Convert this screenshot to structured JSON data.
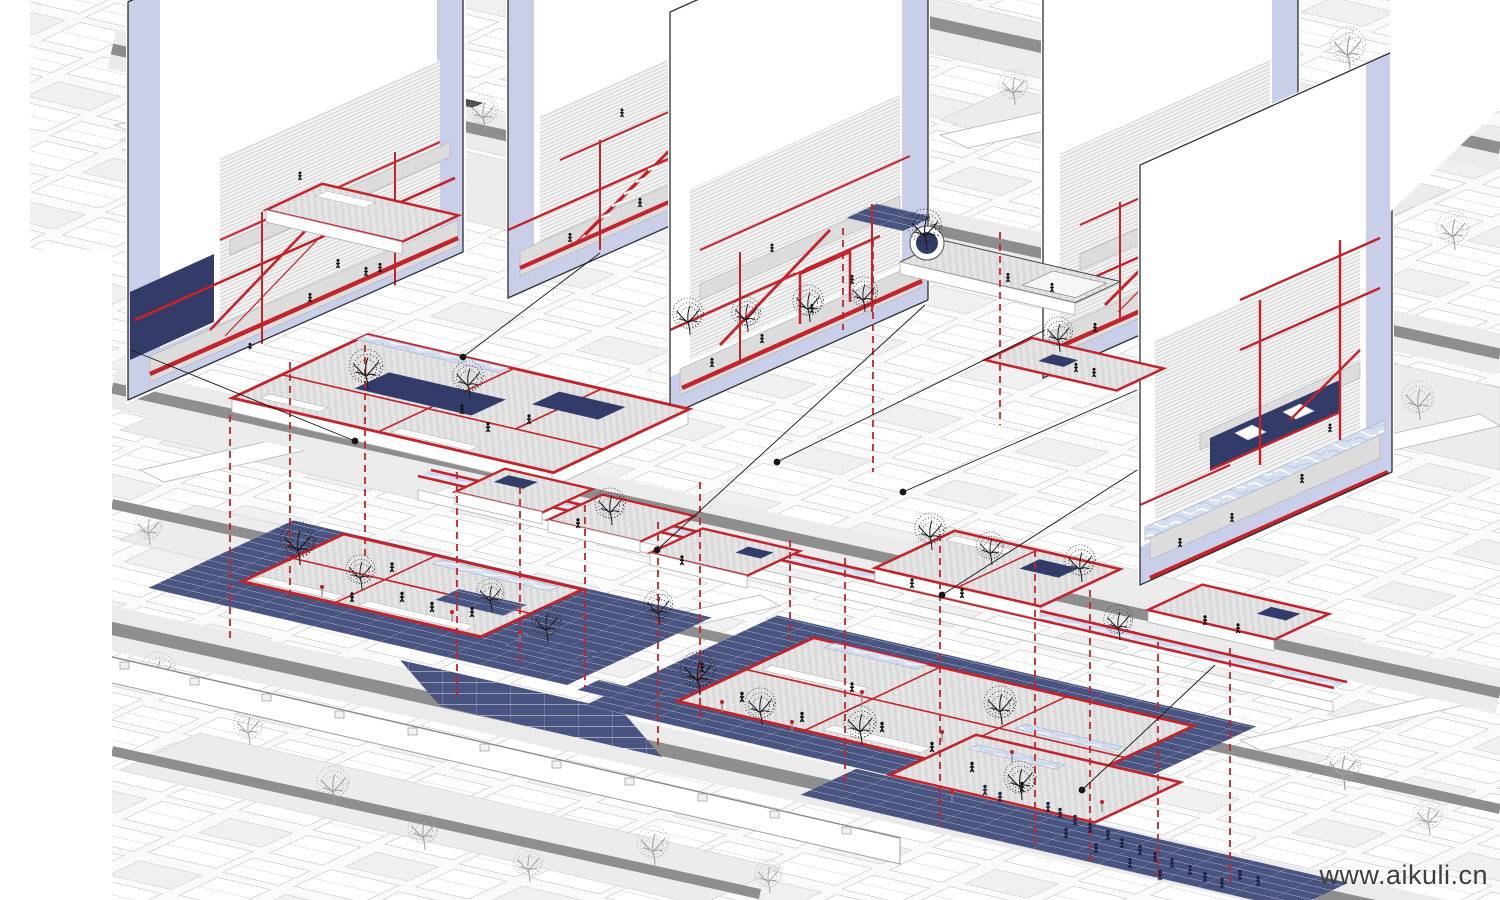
{
  "title": "Hutong linear-axis regeneration axonometric diagram",
  "watermark": {
    "text": "www.aikuli.cn"
  },
  "colors": {
    "red": "#c4232a",
    "navy": "#333c68",
    "tile": "#4a5480",
    "tileLine": "#ffffff",
    "lavender": "#c9cfe8",
    "marble": "#d6dfef",
    "street": "#8e8e8e",
    "lane": "#ebebeb",
    "court": "#ececec",
    "fabric": "#c6c6c6",
    "ink": "#1c1c1c",
    "treeGray": "#a0a0a0",
    "crowd": "#1b2440",
    "watermark": "#3f3f3f"
  },
  "panels": [
    {
      "id": 1,
      "name": "section-panel-far-left"
    },
    {
      "id": 2,
      "name": "section-panel-left-center"
    },
    {
      "id": 3,
      "name": "section-panel-center"
    },
    {
      "id": 4,
      "name": "section-panel-right"
    },
    {
      "id": 5,
      "name": "section-panel-far-right"
    }
  ],
  "layers": {
    "ground": "navy tiled public plazas with grey checker courtyards outlined in red",
    "floating": "red-outlined first-floor plans linked by a glazed water channel",
    "projection": "vertical red dashed lines linking plans to ground",
    "callouts": "black leader lines with dots linking plans to section panels"
  }
}
